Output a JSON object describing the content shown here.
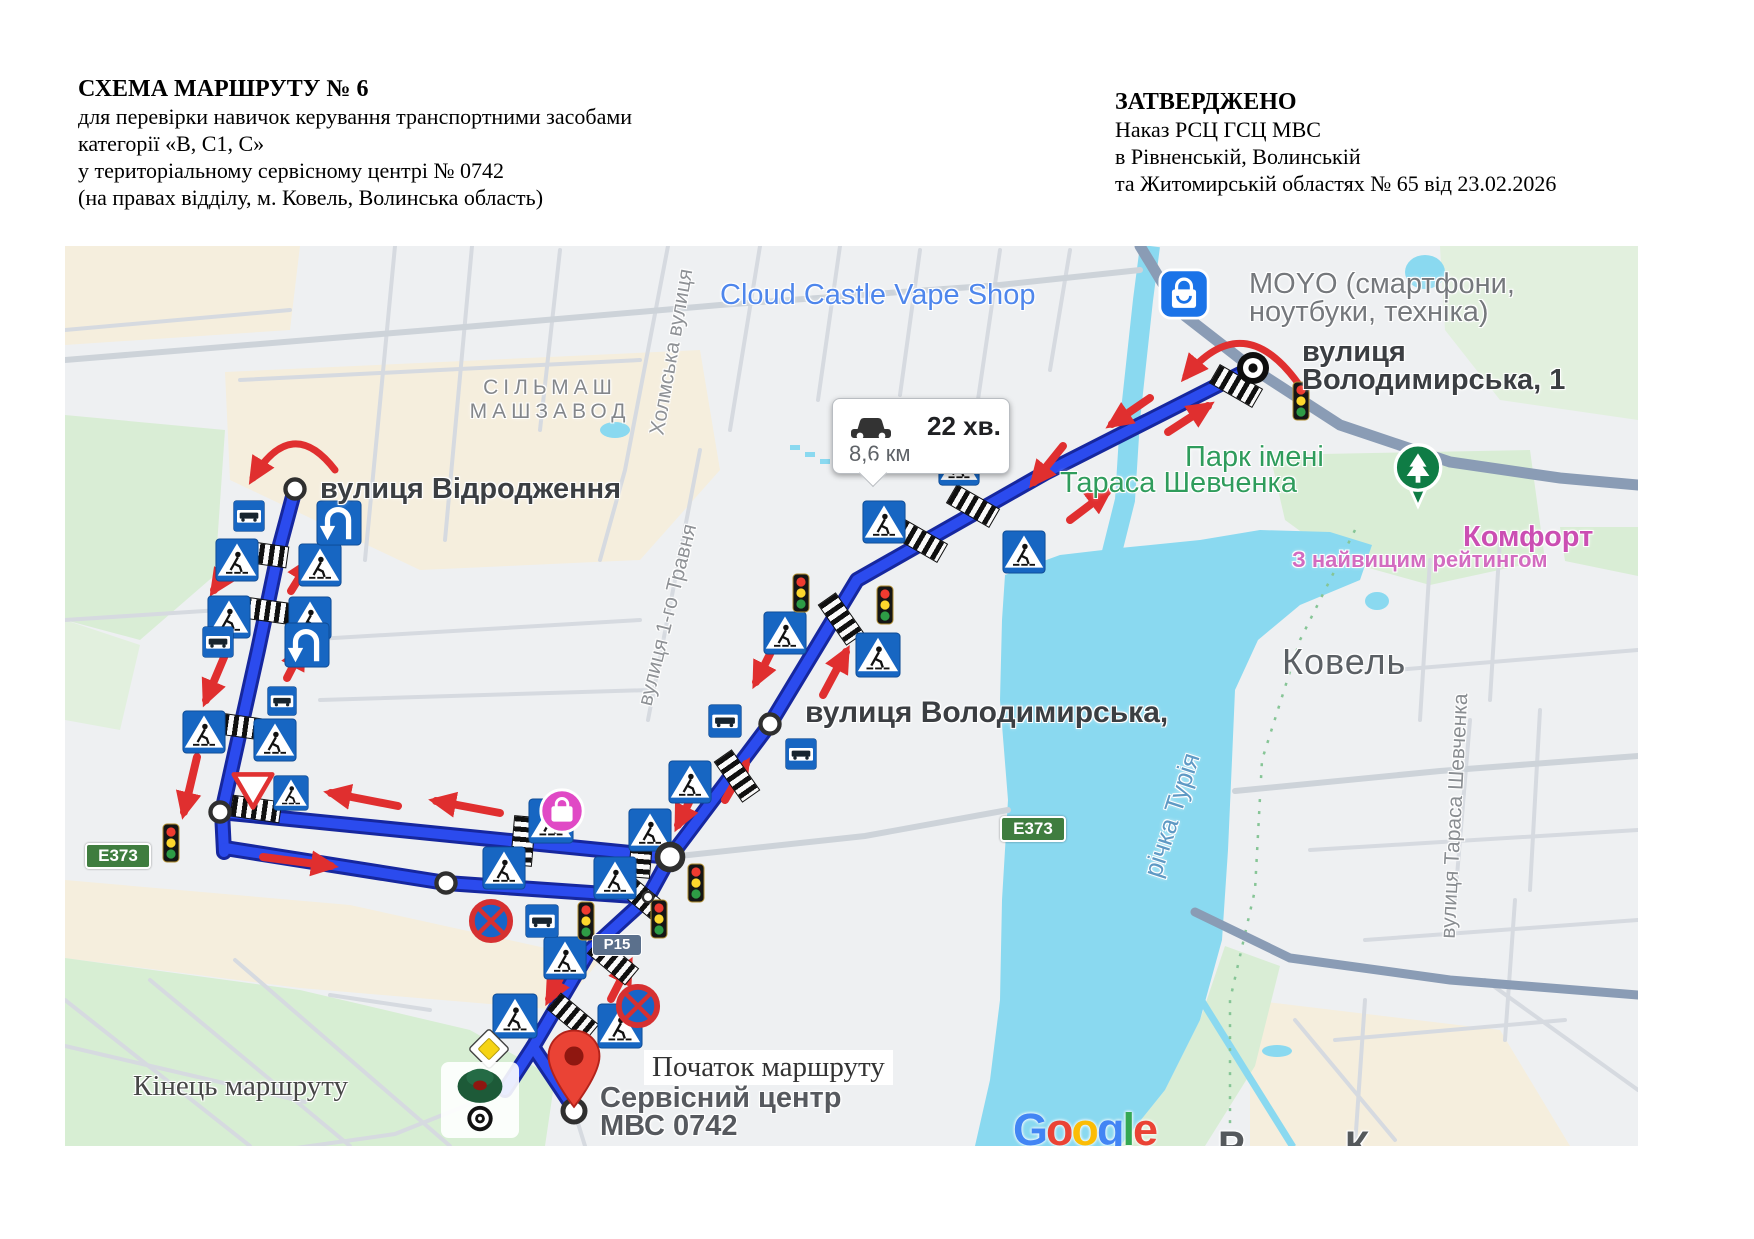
{
  "header": {
    "left": {
      "title": "СХЕМА МАРШРУТУ № 6",
      "line2": "для перевірки навичок керування транспортними засобами",
      "line3": "категорії «В, С1, С»",
      "line4": "у територіальному сервісному центрі № 0742",
      "line5": "(на правах відділу, м. Ковель, Волинська область)"
    },
    "right": {
      "approved": "ЗАТВЕРДЖЕНО",
      "line2": "Наказ РСЦ ГСЦ МВС",
      "line3": "в Рівненській, Волинській",
      "line4": "та Житомирській областях № 65 від 23.02.2026"
    }
  },
  "map": {
    "labels": {
      "vape_shop": "Cloud Castle Vape Shop",
      "moyo_line1": "MOYO (смартфони,",
      "moyo_line2": "ноутбуки, техніка)",
      "volodymyrska1_line1": "вулиця",
      "volodymyrska1_line2": "Володимирська, 1",
      "silmash_line1": "СІЛЬМАШ",
      "silmash_line2": "МАШЗАВОД",
      "vidrodzhennya": "вулиця Відродження",
      "park_line1": "Парк імені",
      "park_line2": "Тараса Шевченка",
      "komfort": "Комфорт",
      "komfort_sub": "З найвищим рейтингом",
      "kovel": "Ковель",
      "volodymyrska": "вулиця Володимирська,",
      "richka": "річка Турія",
      "taras_street": "вулиця Тараса Шевченка",
      "kholmska": "Холмська вулиця",
      "travnya": "вулиця 1-го Травня",
      "kinets": "Кінець маршруту",
      "pochatok": "Початок маршруту",
      "service_line1": "Сервісний центр",
      "service_line2": "МВС 0742",
      "cutoff_left": "Р",
      "cutoff_right": "К"
    },
    "route_info": {
      "duration": "22 хв.",
      "distance": "8,6 км"
    },
    "shields": {
      "e373": "E373",
      "p15": "Р15"
    },
    "colors": {
      "route": "#2b4bee",
      "route_casing": "#16279e",
      "arrow_red": "#e02f2f",
      "water": "#8ad9f0",
      "park_green": "#d9edd5",
      "district_beige": "#f5eedd",
      "land": "#eef0f2",
      "slate_road": "#8a9cb5",
      "sign_blue": "#1766c2",
      "poi_blue_label": "#4e86ec",
      "poi_gray_label": "#75787c",
      "park_label": "#2f9c5c",
      "pink_label": "#cb4fb3",
      "city_label": "#5b6065"
    }
  },
  "google": {
    "letters": [
      "G",
      "o",
      "o",
      "g",
      "l",
      "e"
    ],
    "colors": [
      "#4285F4",
      "#EA4335",
      "#FBBC05",
      "#4285F4",
      "#34A853",
      "#EA4335"
    ]
  },
  "icons": {
    "pedestrian-crossing-sign": "blue square road sign: pedestrian crossing",
    "bus-stop-sign": "blue square road sign: bus stop",
    "u-turn-sign": "blue square road sign: U-turn place",
    "traffic-light": "traffic light",
    "no-stopping-sign": "round road sign: no stopping",
    "give-way-sign": "triangle road sign: give way",
    "priority-road-sign": "diamond road sign: priority road",
    "zebra-crossing": "crosswalk zebra marking",
    "route-waypoint": "white route waypoint circle",
    "route-turn-target": "black target marker (turning point)",
    "start-pin": "red map pin (route start, service centre)",
    "end-marker": "dark green route end marker with bullseye",
    "tree-pin": "green park POI pin",
    "moyo-store-pin": "blue shopping-bag store pin",
    "shopping-poi": "pink POI circle",
    "car": "car icon in route info bubble",
    "u-turn-arrow": "red curved U-turn arrow",
    "direction-arrow": "red direction arrow",
    "google-logo": "Google watermark"
  }
}
